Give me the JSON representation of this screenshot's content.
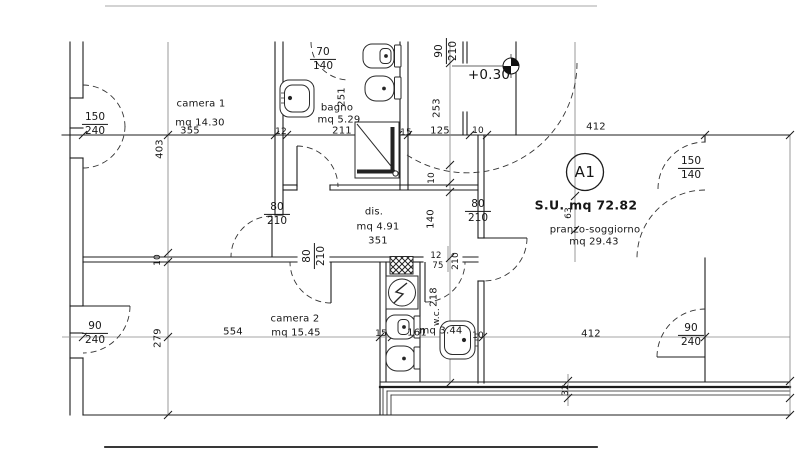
{
  "title": {
    "unit": "A1",
    "surface": "S.U. mq 72.82",
    "elevation": "+0.30"
  },
  "rooms": {
    "camera1": {
      "name": "camera 1",
      "area": "mq 14.30"
    },
    "bagno": {
      "name": "bagno",
      "area": "mq 5.29"
    },
    "dis": {
      "name": "dis.",
      "area": "mq 4.91"
    },
    "camera2": {
      "name": "camera 2",
      "area": "mq 15.45"
    },
    "wc": {
      "name": "w.c.",
      "area": "mq 3.44"
    },
    "pranzo": {
      "name": "pranzo-soggiorno",
      "area": "mq 29.43"
    }
  },
  "openings": {
    "window_camera1": {
      "w": "150",
      "h": "240"
    },
    "window_bagno": {
      "w": "70",
      "h": "140"
    },
    "door_entrance": {
      "w": "90",
      "h": "210"
    },
    "window_pranzo": {
      "w": "150",
      "h": "140"
    },
    "door_camera1": {
      "w": "80",
      "h": "210"
    },
    "door_pranzo": {
      "w": "80",
      "h": "210"
    },
    "door_camera2": {
      "w": "80",
      "h": "210"
    },
    "door_wc": {
      "w": "75",
      "h": "210"
    },
    "window_camera2": {
      "w": "90",
      "h": "240"
    },
    "window_soggiorno": {
      "w": "90",
      "h": "240"
    }
  },
  "dimensions": {
    "top_row": {
      "d355": "355",
      "d12": "12",
      "d211": "211",
      "d15": "15",
      "d125": "125",
      "d10": "10",
      "d412": "412"
    },
    "mid_row": {
      "d554": "554",
      "d15": "15",
      "d161": "161",
      "d10": "10",
      "d412": "412"
    },
    "vertical_left": {
      "d403": "403",
      "d10": "10",
      "d279": "279"
    },
    "vertical_center": {
      "d251": "251",
      "d253": "253",
      "d10": "10",
      "d140": "140",
      "d218": "218",
      "d12": "12"
    },
    "vertical_right": {
      "d63": "63",
      "d32": "32"
    },
    "dis_width": "351"
  },
  "colors": {
    "line": "#1c1c1c",
    "dim_line": "#888888",
    "background": "#ffffff"
  }
}
